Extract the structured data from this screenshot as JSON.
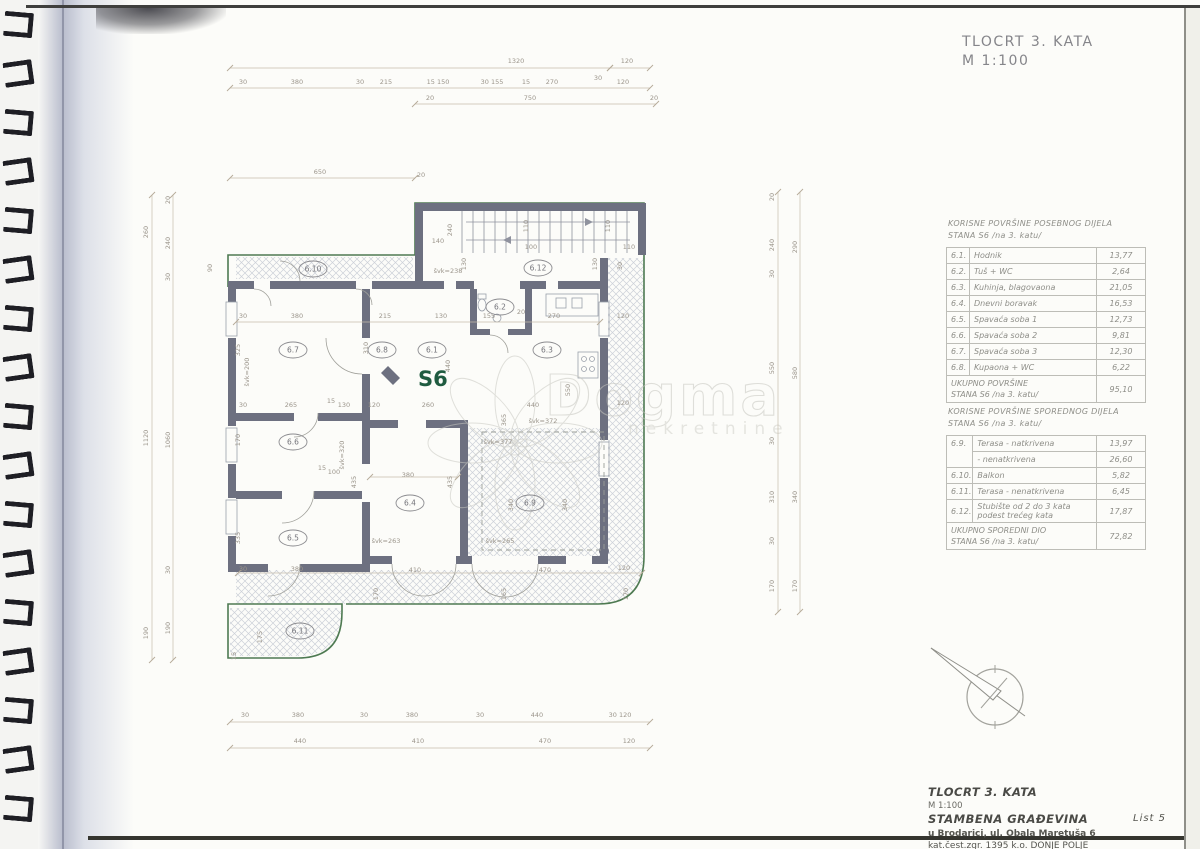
{
  "sheet": {
    "title": "TLOCRT 3. KATA",
    "scale": "M 1:100",
    "list_label": "List 5"
  },
  "title_block": {
    "line1": "TLOCRT 3. KATA",
    "line2": "M 1:100",
    "line3": "STAMBENA GRAĐEVINA",
    "line4": "u Brodarici, ul. Obala Maretuša 6",
    "line5": "kat.čest.zgr. 1395 k.o. DONJE POLJE"
  },
  "watermark": {
    "word": "Dogma",
    "sub": "nekretnine"
  },
  "tables": {
    "special": {
      "title_line1": "KORISNE POVRŠINE POSEBNOG DIJELA",
      "title_line2": "STANA S6 /na 3. katu/",
      "rows": [
        {
          "no": "6.1.",
          "label": "Hodnik",
          "value": "13,77"
        },
        {
          "no": "6.2.",
          "label": "Tuš + WC",
          "value": "2,64"
        },
        {
          "no": "6.3.",
          "label": "Kuhinja, blagovaona",
          "value": "21,05"
        },
        {
          "no": "6.4.",
          "label": "Dnevni boravak",
          "value": "16,53"
        },
        {
          "no": "6.5.",
          "label": "Spavaća soba 1",
          "value": "12,73"
        },
        {
          "no": "6.6.",
          "label": "Spavaća soba 2",
          "value": "9,81"
        },
        {
          "no": "6.7.",
          "label": "Spavaća soba 3",
          "value": "12,30"
        },
        {
          "no": "6.8.",
          "label": "Kupaona + WC",
          "value": "6,22"
        }
      ],
      "total_label_line1": "UKUPNO POVRŠINE",
      "total_label_line2": "STANA S6 /na 3. katu/",
      "total_value": "95,10"
    },
    "secondary": {
      "title_line1": "KORISNE POVRŠINE SPOREDNOG DIJELA",
      "title_line2": "STANA S6 /na 3. katu/",
      "rows": [
        {
          "no": "6.9.",
          "label": "Terasa - natkrivena",
          "value": "13,97"
        },
        {
          "no": "",
          "label": "- nenatkrivena",
          "value": "26,60"
        },
        {
          "no": "6.10.",
          "label": "Balkon",
          "value": "5,82"
        },
        {
          "no": "6.11.",
          "label": "Terasa - nenatkrivena",
          "value": "6,45"
        },
        {
          "no": "6.12.",
          "label": "Stubište od 2 do 3 kata\npodest trećeg kata",
          "value": "17,87"
        }
      ],
      "total_label_line1": "UKUPNO SPOREDNI DIO",
      "total_label_line2": "STANA S6 /na 3. katu/",
      "total_value": "72,82"
    }
  },
  "plan": {
    "unit_label": "S6",
    "rooms": [
      {
        "id": "6.1",
        "x": 432,
        "y": 350
      },
      {
        "id": "6.2",
        "x": 500,
        "y": 307
      },
      {
        "id": "6.3",
        "x": 547,
        "y": 350
      },
      {
        "id": "6.4",
        "x": 410,
        "y": 503
      },
      {
        "id": "6.5",
        "x": 293,
        "y": 538
      },
      {
        "id": "6.6",
        "x": 293,
        "y": 442
      },
      {
        "id": "6.7",
        "x": 293,
        "y": 350
      },
      {
        "id": "6.8",
        "x": 382,
        "y": 350
      },
      {
        "id": "6.9",
        "x": 530,
        "y": 503
      },
      {
        "id": "6.10",
        "x": 313,
        "y": 269
      },
      {
        "id": "6.11",
        "x": 300,
        "y": 631
      },
      {
        "id": "6.12",
        "x": 538,
        "y": 268
      }
    ],
    "dim_lines": [
      [
        230,
        68,
        610,
        68
      ],
      [
        610,
        68,
        650,
        68
      ],
      [
        230,
        88,
        650,
        88
      ],
      [
        415,
        104,
        656,
        104
      ],
      [
        230,
        178,
        415,
        178
      ],
      [
        230,
        722,
        650,
        722
      ],
      [
        230,
        748,
        650,
        748
      ],
      [
        152,
        195,
        152,
        660
      ],
      [
        173,
        195,
        173,
        660
      ],
      [
        778,
        192,
        778,
        612
      ],
      [
        800,
        192,
        800,
        612
      ],
      [
        236,
        322,
        600,
        322
      ],
      [
        370,
        477,
        458,
        477
      ],
      [
        238,
        573,
        642,
        573
      ]
    ],
    "dim_labels": [
      [
        "1320",
        516,
        63
      ],
      [
        "120",
        627,
        63
      ],
      [
        "30",
        243,
        84
      ],
      [
        "380",
        297,
        84
      ],
      [
        "30",
        360,
        84
      ],
      [
        "215",
        386,
        84
      ],
      [
        "15 150",
        438,
        84
      ],
      [
        "30 155",
        492,
        84
      ],
      [
        "15",
        526,
        84
      ],
      [
        "270",
        552,
        84
      ],
      [
        "30",
        598,
        80
      ],
      [
        "120",
        623,
        84
      ],
      [
        "20",
        430,
        100
      ],
      [
        "750",
        530,
        100
      ],
      [
        "20",
        654,
        100
      ],
      [
        "650",
        320,
        174
      ],
      [
        "20",
        421,
        177
      ],
      [
        "140",
        438,
        243
      ],
      [
        "240",
        452,
        230,
        -90
      ],
      [
        "100",
        531,
        249
      ],
      [
        "110",
        629,
        249
      ],
      [
        "110",
        528,
        226,
        -90
      ],
      [
        "110",
        610,
        226,
        -90
      ],
      [
        "130",
        466,
        264,
        -90
      ],
      [
        "130",
        597,
        264,
        -90
      ],
      [
        "švk=238",
        448,
        273
      ],
      [
        "30",
        622,
        266,
        -90
      ],
      [
        "30",
        243,
        318
      ],
      [
        "380",
        297,
        318
      ],
      [
        "215",
        385,
        318
      ],
      [
        "130",
        441,
        318
      ],
      [
        "155",
        489,
        318
      ],
      [
        "270",
        554,
        318
      ],
      [
        "120",
        623,
        318
      ],
      [
        "20",
        521,
        314
      ],
      [
        "325",
        240,
        350,
        -90
      ],
      [
        "švk=200",
        249,
        372,
        -90
      ],
      [
        "310",
        368,
        348,
        -90
      ],
      [
        "440",
        450,
        366,
        -90
      ],
      [
        "550",
        570,
        390,
        -90
      ],
      [
        "30",
        243,
        407
      ],
      [
        "265",
        291,
        407
      ],
      [
        "15",
        331,
        403
      ],
      [
        "130",
        344,
        407
      ],
      [
        "120",
        374,
        407
      ],
      [
        "260",
        428,
        407
      ],
      [
        "365",
        506,
        420,
        -90
      ],
      [
        "440",
        533,
        407
      ],
      [
        "120",
        623,
        405
      ],
      [
        "15",
        322,
        470
      ],
      [
        "100",
        334,
        474
      ],
      [
        "380",
        408,
        477
      ],
      [
        "435",
        356,
        482,
        -90
      ],
      [
        "435",
        452,
        482,
        -90
      ],
      [
        "švk=320",
        344,
        455,
        -90
      ],
      [
        "švk=372",
        543,
        423
      ],
      [
        "švk=377",
        498,
        444
      ],
      [
        "170",
        240,
        440,
        -90
      ],
      [
        "335",
        240,
        538,
        -90
      ],
      [
        "švk=263",
        386,
        543
      ],
      [
        "švk=265",
        500,
        543
      ],
      [
        "30",
        243,
        571
      ],
      [
        "380",
        297,
        571
      ],
      [
        "410",
        415,
        572
      ],
      [
        "470",
        545,
        572
      ],
      [
        "120",
        624,
        570
      ],
      [
        "170",
        378,
        594,
        -90
      ],
      [
        "165",
        506,
        594,
        -90
      ],
      [
        "170",
        628,
        594,
        -90
      ],
      [
        "340",
        513,
        505,
        -90
      ],
      [
        "340",
        567,
        505,
        -90
      ],
      [
        "175",
        262,
        637,
        -90
      ],
      [
        "15",
        236,
        656,
        -90
      ],
      [
        "30",
        245,
        717
      ],
      [
        "380",
        298,
        717
      ],
      [
        "30",
        364,
        717
      ],
      [
        "380",
        412,
        717
      ],
      [
        "30",
        480,
        717
      ],
      [
        "440",
        537,
        717
      ],
      [
        "30 120",
        620,
        717
      ],
      [
        "440",
        300,
        743
      ],
      [
        "410",
        418,
        743
      ],
      [
        "470",
        545,
        743
      ],
      [
        "120",
        629,
        743
      ],
      [
        "260",
        148,
        232,
        -90
      ],
      [
        "1120",
        148,
        438,
        -90
      ],
      [
        "190",
        148,
        633,
        -90
      ],
      [
        "20",
        170,
        200,
        -90
      ],
      [
        "240",
        170,
        243,
        -90
      ],
      [
        "30",
        170,
        277,
        -90
      ],
      [
        "1060",
        170,
        440,
        -90
      ],
      [
        "30",
        170,
        570,
        -90
      ],
      [
        "190",
        170,
        628,
        -90
      ],
      [
        "90",
        212,
        268,
        -90
      ],
      [
        "20",
        774,
        197,
        -90
      ],
      [
        "240",
        774,
        245,
        -90
      ],
      [
        "30",
        774,
        274,
        -90
      ],
      [
        "550",
        774,
        368,
        -90
      ],
      [
        "30",
        774,
        441,
        -90
      ],
      [
        "310",
        774,
        497,
        -90
      ],
      [
        "30",
        774,
        541,
        -90
      ],
      [
        "170",
        774,
        586,
        -90
      ],
      [
        "290",
        797,
        247,
        -90
      ],
      [
        "580",
        797,
        373,
        -90
      ],
      [
        "340",
        797,
        497,
        -90
      ],
      [
        "170",
        797,
        586,
        -90
      ]
    ]
  }
}
